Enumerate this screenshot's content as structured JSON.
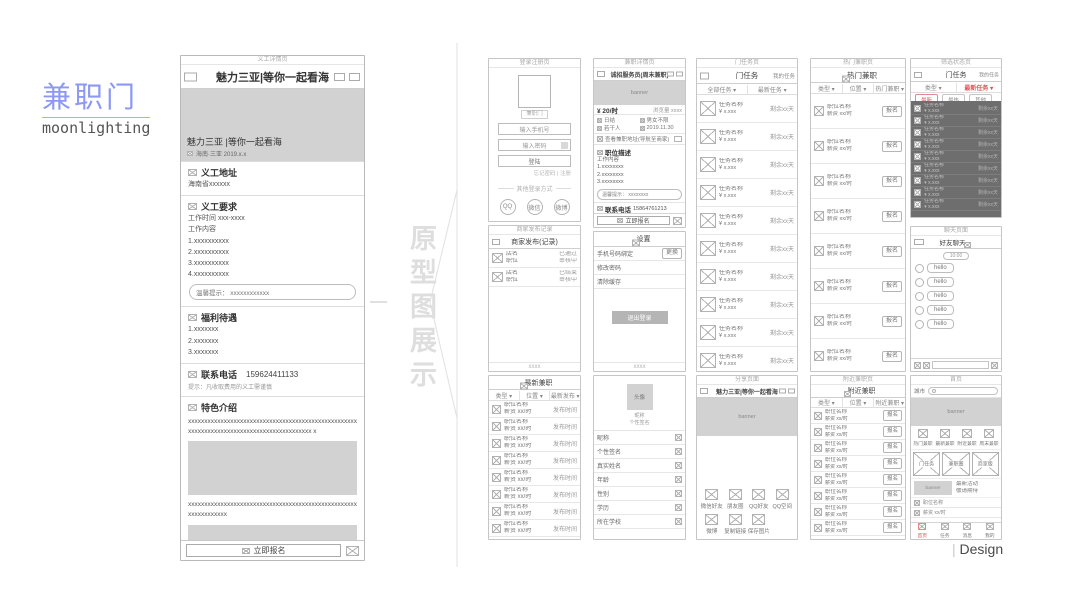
{
  "logo": {
    "title": "兼职门",
    "subtitle": "moonlighting"
  },
  "divider": {
    "label": "原型图展示"
  },
  "credit": {
    "bar": "|",
    "label": "Design"
  },
  "detail": {
    "caption": "义工详情页",
    "title": "魅力三亚|等你一起看海",
    "hero_title": "魅力三亚 |等你一起看海",
    "hero_meta": "海南·三亚  2019.x.x",
    "addr_title": "义工地址",
    "addr_value": "海南省xxxxxx",
    "req_title": "义工要求",
    "req_lines": [
      "工作时间 xxx-xxxx",
      "工作内容",
      "1.xxxxxxxxxx",
      "2.xxxxxxxxxx",
      "3.xxxxxxxxxx",
      "4.xxxxxxxxxx"
    ],
    "req_tip": "温馨提示：  xxxxxxxxxxxx",
    "welfare_title": "福利待遇",
    "welfare_lines": [
      "1.xxxxxxx",
      "2.xxxxxxx",
      "3.xxxxxxx"
    ],
    "contact_title": "联系电话",
    "contact_phone": "159624411133",
    "contact_hint": "提示：凡收取费用的义工需谨慎",
    "feature_title": "特色介绍",
    "feature_para1": "xxxxxxxxxxxxxxxxxxxxxxxxxxxxxxxxxxxxxxxxxxxxxxxxxxxxxxxxxxxxxxxxxxxxxxxxxxxxxxxxxxxxxxxxxx x",
    "feature_para2": "xxxxxxxxxxxxxxxxxxxxxxxxxxxxxxxxxxxxxxxxxxxxxxxxxxxxxxxxxxxxxxxx",
    "cta": "立即报名"
  },
  "login": {
    "caption": "登录注册页",
    "logo_label": "兼职门",
    "phone_placeholder": "输入手机号",
    "password_placeholder": "输入密码",
    "submit": "登陆",
    "links": "忘记密码 | 注册",
    "divider": "其他登录方式",
    "qq": "QQ",
    "wechat": "微信",
    "weibo": "微博",
    "footer": "用户协议"
  },
  "publish": {
    "caption": "商家发布记录",
    "title": "商家发布(记录)",
    "rows": [
      {
        "l1": "店名",
        "l2": "职位",
        "r1": "已通过",
        "r2": "审核中"
      },
      {
        "l1": "店名",
        "l2": "职位",
        "r1": "已结束",
        "r2": "审核中"
      }
    ],
    "footer": "xxxx"
  },
  "latest": {
    "caption": "最新兼职页",
    "title": "最新兼职",
    "filters": [
      "类型 ▾",
      "位置 ▾",
      "最新发布 ▾"
    ],
    "row_l1": "职位名称",
    "row_l2": "薪资 xx/时",
    "row_r": "发布时间"
  },
  "job": {
    "caption": "兼职详情页",
    "title": "诚招服务员(周末兼职)",
    "banner": "banner",
    "price": "¥ 20/时",
    "views": "浏览量 xxxx",
    "info": [
      "日结",
      "男女不限",
      "若干人",
      "2019.11.30"
    ],
    "location": "查看兼职地址(导航至商家)",
    "desc_title": "职位描述",
    "desc_lines": [
      "工作内容",
      "1.xxxxxxxx",
      "2.xxxxxxxx",
      "3.xxxxxxxx"
    ],
    "desc_tip": "温馨提示： xxxxxxxx",
    "contact_title": "联系电话",
    "contact_phone": "15864761213",
    "contact_hint": "提示：凡收取费用的兼职需谨慎",
    "applicants": "这些用户报名了该兼职",
    "cta": "立即报名"
  },
  "settings": {
    "caption": "设置页",
    "title": "设置",
    "row1": "手机号码绑定",
    "row1_action": "更换",
    "row2": "修改密码",
    "row3": "清除缓存",
    "logout": "退出登录",
    "footer": "xxxx"
  },
  "profile": {
    "caption": "个人资料页",
    "avatar": "头像",
    "sub1": "昵称",
    "sub2": "个性签名",
    "rows": [
      "昵称",
      "个性签名",
      "真实姓名",
      "年龄",
      "性别",
      "学历",
      "所在学校"
    ]
  },
  "tasks": {
    "caption": "门任务页",
    "title": "门任务",
    "mine": "我的任务",
    "filters": [
      "全部任务 ▾",
      "最新任务 ▾"
    ],
    "row_l1": "任务名称",
    "row_l2": "¥ x.xxx",
    "row_r": "剩余xx天"
  },
  "share": {
    "caption": "分享页面",
    "title": "魅力三亚|等你一起看海",
    "banner": "banner",
    "row1": [
      "微信好友",
      "朋友圈",
      "QQ好友",
      "QQ空间"
    ],
    "row2": [
      "微博",
      "复制链接",
      "保存图片"
    ]
  },
  "hot": {
    "caption": "热门兼职页",
    "title": "热门兼职",
    "filters": [
      "类型 ▾",
      "位置 ▾",
      "热门兼职 ▾"
    ],
    "row_l1": "职位名称",
    "row_l2": "薪资 xx/时",
    "row_btn": "报名"
  },
  "nearby": {
    "caption": "附近兼职页",
    "title": "附近兼职",
    "filters": [
      "类型 ▾",
      "位置 ▾",
      "附近兼职 ▾"
    ],
    "row_l1": "职位名称",
    "row_l2": "薪资 xx/时",
    "row_btn": "报名"
  },
  "filter": {
    "caption": "筛选状态页",
    "title": "门任务",
    "mine": "我的任务",
    "f1": "类型 ▾",
    "f2": "最新任务 ▾",
    "chips": [
      "最新",
      "最热",
      "其他"
    ],
    "row_l1": "任务名称",
    "row_l2": "¥ x.xxx",
    "row_r": "剩余xx天"
  },
  "chat": {
    "caption": "聊天页面",
    "title": "好友聊天",
    "time": "10:00",
    "bubble": "hello"
  },
  "home": {
    "caption": "首页",
    "city": "城市",
    "banner": "banner",
    "cats": [
      "热门兼职",
      "最新兼职",
      "附近兼职",
      "周末兼职"
    ],
    "boxes": [
      "门任务",
      "兼职圈",
      "商家版"
    ],
    "promo_line1": "最新活动",
    "promo_line2": "敬请期待",
    "row_l1": "职位名称",
    "row_l2": "薪资 xx/时",
    "tabs": [
      "首页",
      "任务",
      "消息",
      "我的"
    ]
  }
}
